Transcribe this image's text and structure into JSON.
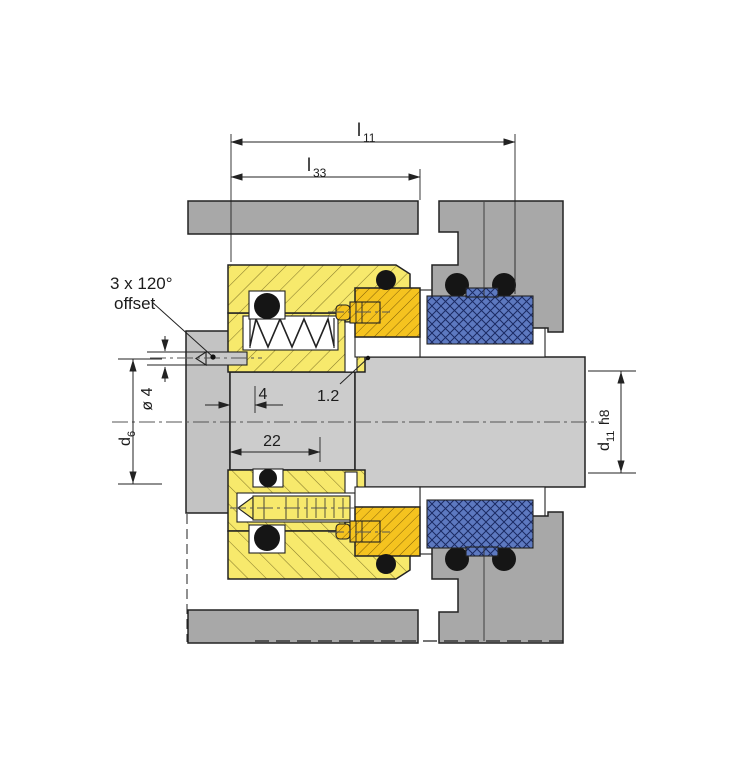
{
  "labels": {
    "l11": {
      "base": "l",
      "sub": "11"
    },
    "l33": {
      "base": "l",
      "sub": "33"
    },
    "note": {
      "line1": "3 x 120°",
      "line2": "offset"
    },
    "phi4": "ø 4",
    "d6": {
      "base": "d",
      "sub": "6"
    },
    "dim4": "4",
    "surface12": "1.2",
    "dim22": "22",
    "d11": {
      "base": "d",
      "sub": "11",
      "tol": "h8"
    }
  },
  "colors": {
    "housing_gray": "#a8a8a8",
    "shaft_gray": "#cccccc",
    "collar_gray": "#c3c3c3",
    "screw_gray": "#c9c9c9",
    "seal_yellow": "#f7e96c",
    "seat_orange": "#f5c31f",
    "bellows_blue": "#5d79c0",
    "oring_black": "#151515"
  }
}
